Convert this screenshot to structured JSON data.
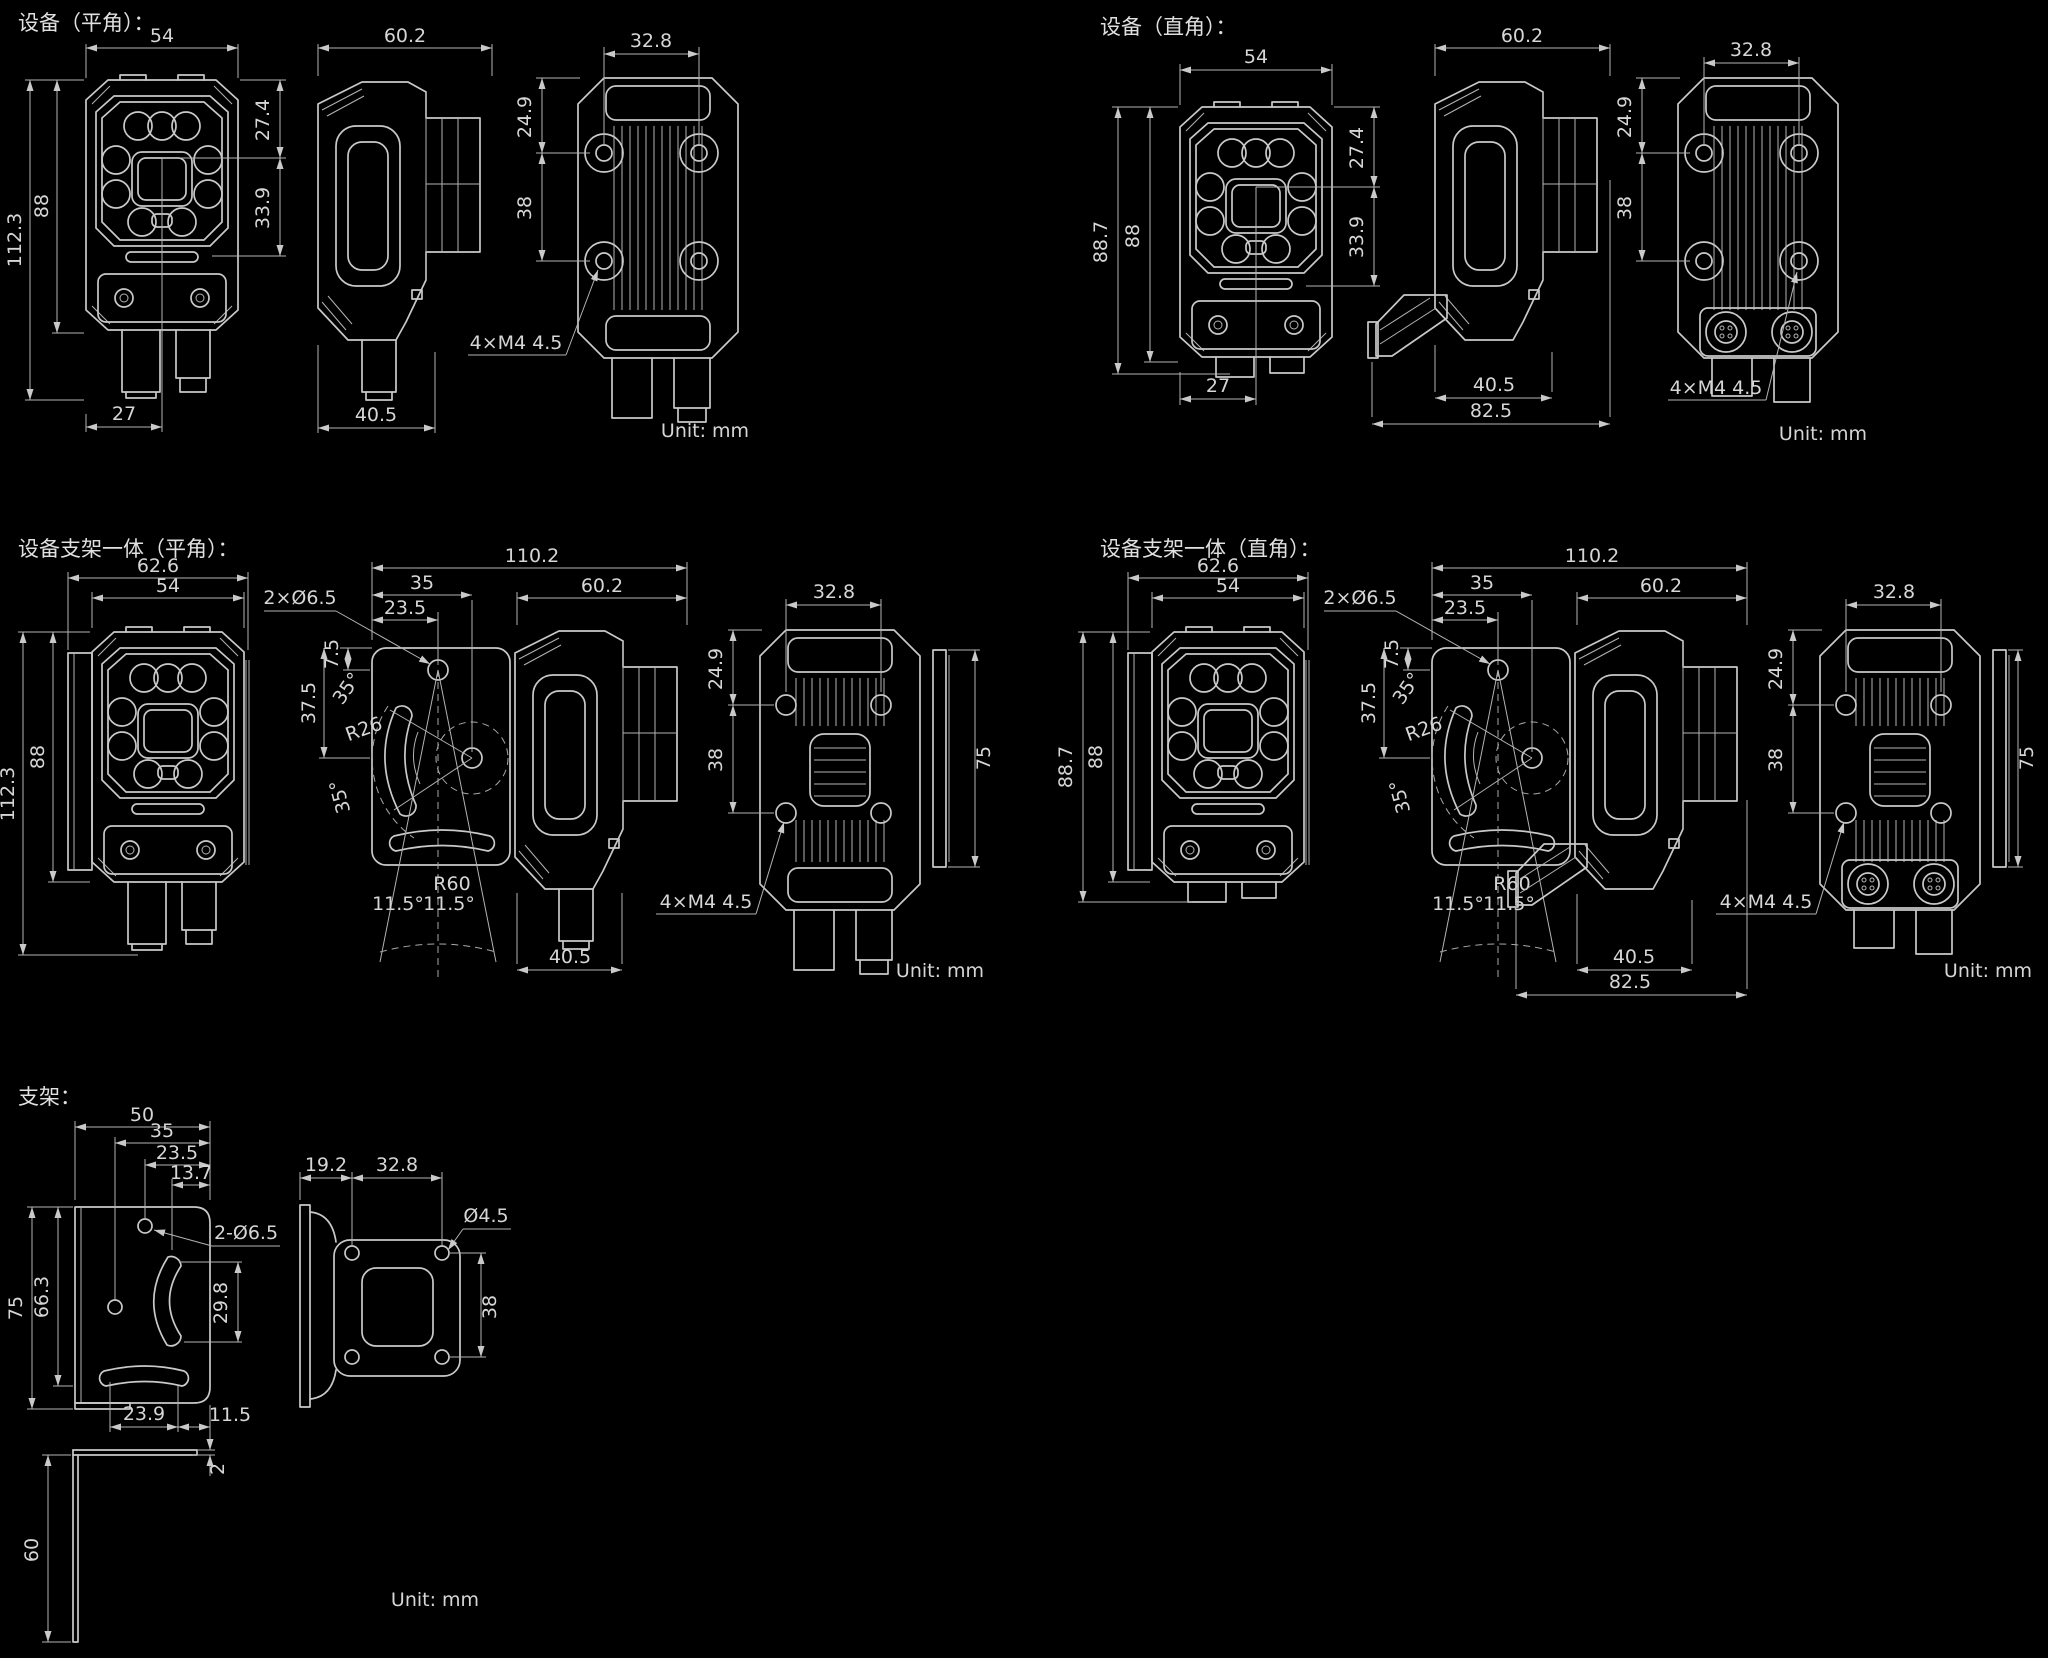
{
  "meta": {
    "background": "#000000",
    "line_color": "#c9c9c9",
    "text_color": "#d6d6d6",
    "unit_label": "Unit: mm"
  },
  "panels": {
    "device_straight": {
      "title": "设备（平角）：",
      "front": {
        "width": "54",
        "height_total": "112.3",
        "height_body": "88",
        "top_to_lens_center": "27.4",
        "lens_center_to_step": "33.9",
        "bottom_to_center": "27"
      },
      "side": {
        "depth": "60.2",
        "front_to_mount": "40.5"
      },
      "back": {
        "hole_pitch_h": "32.8",
        "top_to_hole": "24.9",
        "hole_pitch_v": "38",
        "thread_callout": "4×M4 4.5"
      }
    },
    "device_elbow": {
      "title": "设备（直角）：",
      "front": {
        "width": "54",
        "height_total": "88.7",
        "height_body": "88",
        "top_to_lens_center": "27.4",
        "lens_center_to_step": "33.9",
        "bottom_to_center": "27"
      },
      "side": {
        "depth": "60.2",
        "front_to_mount": "40.5",
        "total_depth": "82.5"
      },
      "back": {
        "hole_pitch_h": "32.8",
        "top_to_hole": "24.9",
        "hole_pitch_v": "38",
        "thread_callout": "4×M4 4.5"
      }
    },
    "assembly_straight": {
      "title": "设备支架一体（平角）：",
      "front": {
        "bracket_width": "62.6",
        "width": "54",
        "height_total": "112.3",
        "height_body": "88"
      },
      "bracket": {
        "hole_callout": "2×Ø6.5",
        "total_depth": "110.2",
        "edge_to_pivot2": "35",
        "edge_to_pivot1": "23.5",
        "top_to_pivot": "7.5",
        "pivot_offset": "37.5",
        "angle_up": "35°",
        "angle_down": "35°",
        "slot_radius": "R26",
        "swing_radius": "R60",
        "swing_left": "11.5°",
        "swing_right": "11.5°"
      },
      "side": {
        "depth": "60.2",
        "front_to_mount": "40.5"
      },
      "back": {
        "hole_pitch_h": "32.8",
        "top_to_hole": "24.9",
        "hole_pitch_v": "38",
        "plate_height": "75",
        "thread_callout": "4×M4 4.5"
      }
    },
    "assembly_elbow": {
      "title": "设备支架一体（直角）：",
      "front": {
        "bracket_width": "62.6",
        "width": "54",
        "height_total": "88.7",
        "height_body": "88"
      },
      "bracket": {
        "hole_callout": "2×Ø6.5",
        "total_depth": "110.2",
        "edge_to_pivot2": "35",
        "edge_to_pivot1": "23.5",
        "top_to_pivot": "7.5",
        "pivot_offset": "37.5",
        "angle_up": "35°",
        "angle_down": "35°",
        "slot_radius": "R26",
        "swing_radius": "R60",
        "swing_left": "11.5°",
        "swing_right": "11.5°"
      },
      "side": {
        "depth": "60.2",
        "front_to_mount": "40.5",
        "total_depth": "82.5"
      },
      "back": {
        "hole_pitch_h": "32.8",
        "top_to_hole": "24.9",
        "hole_pitch_v": "38",
        "plate_height": "75",
        "thread_callout": "4×M4 4.5"
      }
    },
    "bracket": {
      "title": "支架：",
      "plate": {
        "width": "50",
        "right_to_hole1": "35",
        "right_to_hole2": "23.5",
        "right_to_slot": "13.7",
        "height": "75",
        "height_inner": "66.3",
        "hole_callout": "2-Ø6.5",
        "slot_span": "29.8",
        "slot_to_left": "23.9",
        "slot_to_right": "11.5",
        "thickness": "2",
        "leg_length": "60"
      },
      "side": {
        "edge_offset": "19.2",
        "hole_pitch_h": "32.8",
        "hole_callout": "Ø4.5",
        "hole_pitch_v": "38"
      }
    }
  }
}
